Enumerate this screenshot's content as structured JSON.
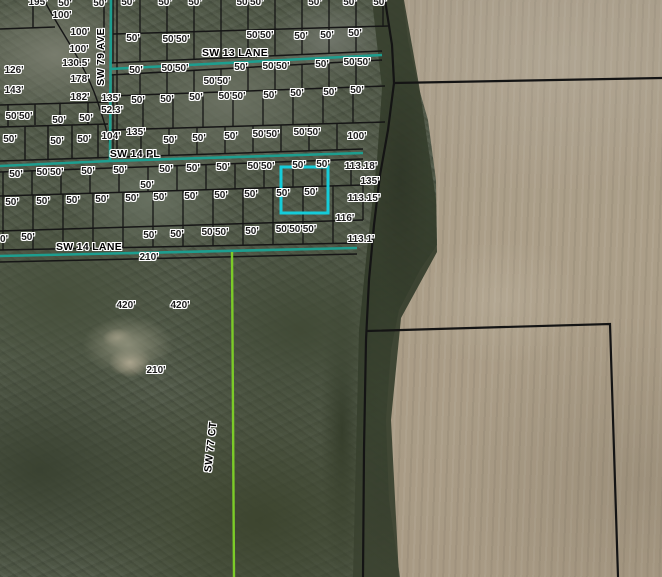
{
  "map": {
    "description": "Aerial parcel map with lot dimension annotations",
    "colors": {
      "street_centerline": "#1d9e8f",
      "unpaved_road_line": "#7ccb28",
      "selected_parcel": "#15ccd9",
      "parcel_line": "#161616",
      "boundary_line": "#141414",
      "label_halo": "#ffffff"
    },
    "streets": [
      {
        "label": "SW 13 LANE"
      },
      {
        "label": "SW 14 PL"
      },
      {
        "label": "SW 14 LANE"
      },
      {
        "label": "SW 79 AVE"
      },
      {
        "label": "SW 77 CT"
      }
    ],
    "labels": [
      {
        "t": "195'",
        "x": 38,
        "y": 3,
        "k": "d"
      },
      {
        "t": "50'",
        "x": 65,
        "y": 4,
        "k": "d"
      },
      {
        "t": "50'",
        "x": 100,
        "y": 4,
        "k": "d"
      },
      {
        "t": "50'",
        "x": 128,
        "y": 3,
        "k": "d"
      },
      {
        "t": "50'",
        "x": 165,
        "y": 3,
        "k": "d"
      },
      {
        "t": "50'",
        "x": 195,
        "y": 3,
        "k": "d"
      },
      {
        "t": "50'50'",
        "x": 250,
        "y": 3,
        "k": "d"
      },
      {
        "t": "50'",
        "x": 315,
        "y": 3,
        "k": "d"
      },
      {
        "t": "50'",
        "x": 350,
        "y": 3,
        "k": "d"
      },
      {
        "t": "50'",
        "x": 380,
        "y": 3,
        "k": "d"
      },
      {
        "t": "100'",
        "x": 62,
        "y": 16,
        "k": "d"
      },
      {
        "t": "100'",
        "x": 80,
        "y": 33,
        "k": "d"
      },
      {
        "t": "50'",
        "x": 133,
        "y": 39,
        "k": "d"
      },
      {
        "t": "50'50'",
        "x": 176,
        "y": 40,
        "k": "d"
      },
      {
        "t": "50'50'",
        "x": 260,
        "y": 36,
        "k": "d"
      },
      {
        "t": "50'",
        "x": 301,
        "y": 37,
        "k": "d"
      },
      {
        "t": "50'",
        "x": 327,
        "y": 36,
        "k": "d"
      },
      {
        "t": "50'",
        "x": 355,
        "y": 34,
        "k": "d"
      },
      {
        "t": "100'",
        "x": 79,
        "y": 50,
        "k": "d"
      },
      {
        "t": "SW 13 LANE",
        "x": 235,
        "y": 53,
        "k": "s"
      },
      {
        "t": "130.5'",
        "x": 76,
        "y": 64,
        "k": "d"
      },
      {
        "t": "126'",
        "x": 14,
        "y": 71,
        "k": "d"
      },
      {
        "t": "50'",
        "x": 136,
        "y": 71,
        "k": "d"
      },
      {
        "t": "50'50'",
        "x": 175,
        "y": 69,
        "k": "d"
      },
      {
        "t": "50'",
        "x": 241,
        "y": 68,
        "k": "d"
      },
      {
        "t": "50'50'",
        "x": 276,
        "y": 67,
        "k": "d"
      },
      {
        "t": "50'",
        "x": 322,
        "y": 65,
        "k": "d"
      },
      {
        "t": "50'50'",
        "x": 357,
        "y": 63,
        "k": "d"
      },
      {
        "t": "178'",
        "x": 80,
        "y": 80,
        "k": "d"
      },
      {
        "t": "50'50'",
        "x": 217,
        "y": 82,
        "k": "d"
      },
      {
        "t": "143'",
        "x": 14,
        "y": 91,
        "k": "d"
      },
      {
        "t": "182'",
        "x": 80,
        "y": 98,
        "k": "d"
      },
      {
        "t": "135'",
        "x": 111,
        "y": 99,
        "k": "d"
      },
      {
        "t": "50'",
        "x": 138,
        "y": 101,
        "k": "d"
      },
      {
        "t": "50'",
        "x": 167,
        "y": 100,
        "k": "d"
      },
      {
        "t": "50'",
        "x": 196,
        "y": 98,
        "k": "d"
      },
      {
        "t": "50'50'",
        "x": 232,
        "y": 97,
        "k": "d"
      },
      {
        "t": "50'",
        "x": 270,
        "y": 96,
        "k": "d"
      },
      {
        "t": "50'",
        "x": 297,
        "y": 94,
        "k": "d"
      },
      {
        "t": "50'",
        "x": 330,
        "y": 93,
        "k": "d"
      },
      {
        "t": "50'",
        "x": 357,
        "y": 91,
        "k": "d"
      },
      {
        "t": "52.3'",
        "x": 112,
        "y": 111,
        "k": "d"
      },
      {
        "t": "50'50'",
        "x": 19,
        "y": 117,
        "k": "d"
      },
      {
        "t": "50'",
        "x": 59,
        "y": 121,
        "k": "d"
      },
      {
        "t": "50'",
        "x": 86,
        "y": 119,
        "k": "d"
      },
      {
        "t": "50'",
        "x": 10,
        "y": 140,
        "k": "d"
      },
      {
        "t": "50'",
        "x": 57,
        "y": 142,
        "k": "d"
      },
      {
        "t": "50'",
        "x": 84,
        "y": 140,
        "k": "d"
      },
      {
        "t": "104'",
        "x": 111,
        "y": 137,
        "k": "d"
      },
      {
        "t": "135'",
        "x": 136,
        "y": 133,
        "k": "d"
      },
      {
        "t": "50'",
        "x": 170,
        "y": 141,
        "k": "d"
      },
      {
        "t": "50'",
        "x": 199,
        "y": 139,
        "k": "d"
      },
      {
        "t": "50'",
        "x": 231,
        "y": 137,
        "k": "d"
      },
      {
        "t": "50'50'",
        "x": 266,
        "y": 135,
        "k": "d"
      },
      {
        "t": "50'50'",
        "x": 307,
        "y": 133,
        "k": "d"
      },
      {
        "t": "100'",
        "x": 357,
        "y": 137,
        "k": "d"
      },
      {
        "t": "SW 14 PL",
        "x": 135,
        "y": 154,
        "k": "s"
      },
      {
        "t": "50'",
        "x": 16,
        "y": 175,
        "k": "d"
      },
      {
        "t": "50'50'",
        "x": 50,
        "y": 173,
        "k": "d"
      },
      {
        "t": "50'",
        "x": 88,
        "y": 172,
        "k": "d"
      },
      {
        "t": "50'",
        "x": 120,
        "y": 171,
        "k": "d"
      },
      {
        "t": "50'",
        "x": 166,
        "y": 170,
        "k": "d"
      },
      {
        "t": "50'",
        "x": 193,
        "y": 169,
        "k": "d"
      },
      {
        "t": "50'",
        "x": 223,
        "y": 168,
        "k": "d"
      },
      {
        "t": "50'50'",
        "x": 261,
        "y": 167,
        "k": "d"
      },
      {
        "t": "50'",
        "x": 299,
        "y": 166,
        "k": "d"
      },
      {
        "t": "50'",
        "x": 323,
        "y": 165,
        "k": "d"
      },
      {
        "t": "113.18'",
        "x": 361,
        "y": 167,
        "k": "d"
      },
      {
        "t": "50'",
        "x": 147,
        "y": 186,
        "k": "d"
      },
      {
        "t": "135'",
        "x": 370,
        "y": 182,
        "k": "d"
      },
      {
        "t": "50'",
        "x": 12,
        "y": 203,
        "k": "d"
      },
      {
        "t": "50'",
        "x": 43,
        "y": 202,
        "k": "d"
      },
      {
        "t": "50'",
        "x": 73,
        "y": 201,
        "k": "d"
      },
      {
        "t": "50'",
        "x": 102,
        "y": 200,
        "k": "d"
      },
      {
        "t": "50'",
        "x": 132,
        "y": 199,
        "k": "d"
      },
      {
        "t": "50'",
        "x": 160,
        "y": 198,
        "k": "d"
      },
      {
        "t": "50'",
        "x": 191,
        "y": 197,
        "k": "d"
      },
      {
        "t": "50'",
        "x": 221,
        "y": 196,
        "k": "d"
      },
      {
        "t": "50'",
        "x": 251,
        "y": 195,
        "k": "d"
      },
      {
        "t": "50'",
        "x": 283,
        "y": 194,
        "k": "d"
      },
      {
        "t": "50'",
        "x": 311,
        "y": 193,
        "k": "d"
      },
      {
        "t": "113.15'",
        "x": 364,
        "y": 199,
        "k": "d"
      },
      {
        "t": "116'",
        "x": 345,
        "y": 219,
        "k": "d"
      },
      {
        "t": "0'",
        "x": 4,
        "y": 240,
        "k": "d"
      },
      {
        "t": "50'",
        "x": 28,
        "y": 238,
        "k": "d"
      },
      {
        "t": "50'",
        "x": 150,
        "y": 236,
        "k": "d"
      },
      {
        "t": "50'",
        "x": 177,
        "y": 235,
        "k": "d"
      },
      {
        "t": "50'50'",
        "x": 215,
        "y": 233,
        "k": "d"
      },
      {
        "t": "50'",
        "x": 252,
        "y": 232,
        "k": "d"
      },
      {
        "t": "50'50'50'",
        "x": 296,
        "y": 230,
        "k": "d"
      },
      {
        "t": "113.1'",
        "x": 361,
        "y": 240,
        "k": "d"
      },
      {
        "t": "SW 14 LANE",
        "x": 89,
        "y": 247,
        "k": "s"
      },
      {
        "t": "210'",
        "x": 149,
        "y": 258,
        "k": "d"
      },
      {
        "t": "420'",
        "x": 126,
        "y": 306,
        "k": "d"
      },
      {
        "t": "420'",
        "x": 180,
        "y": 306,
        "k": "d"
      },
      {
        "t": "210'",
        "x": 156,
        "y": 371,
        "k": "d"
      },
      {
        "t": "SW 79 AVE",
        "x": 101,
        "y": 57,
        "k": "s",
        "r": -90
      },
      {
        "t": "SW 77 CT",
        "x": 211,
        "y": 447,
        "k": "s",
        "r": -84
      }
    ],
    "selected_parcel": {
      "frontage_labels": [
        "50'",
        "50'"
      ],
      "highlight_color": "#15ccd9"
    }
  }
}
